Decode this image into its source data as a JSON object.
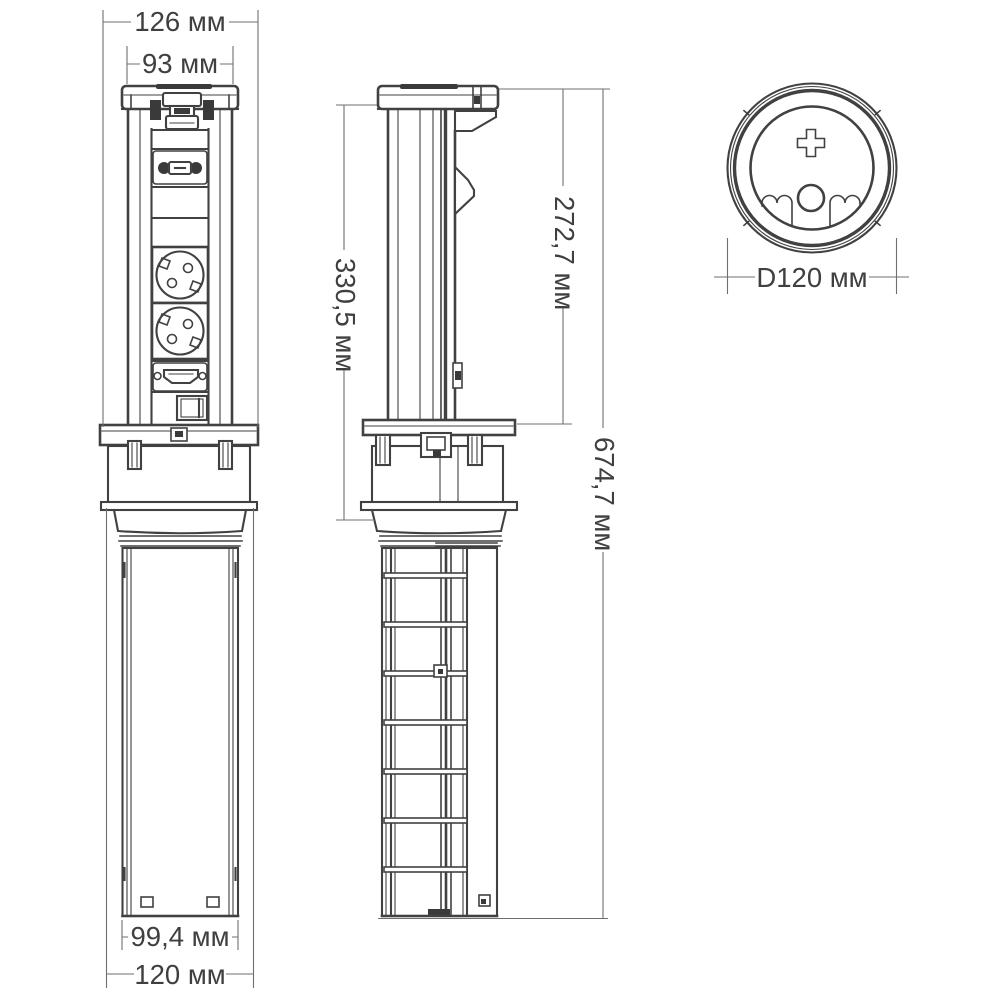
{
  "drawing": {
    "kind": "technical-dimension-drawing",
    "subject": "pop-up-socket-tower",
    "views": [
      "front-view",
      "side-view",
      "top-view"
    ],
    "features": [
      "lid-cap",
      "latch",
      "usb-ports",
      "schuko-socket-top",
      "schuko-socket-bottom",
      "hdmi-port",
      "switch-port",
      "mounting-flange",
      "threaded-collar",
      "locking-nut",
      "under-counter-tube",
      "plus-mark",
      "grip-reliefs"
    ]
  },
  "dims": {
    "front_outer_width": "126 мм",
    "front_cap_width": "93 мм",
    "tube_width": "99,4 мм",
    "base_width": "120 мм",
    "under_height": "330,5 мм",
    "above_height": "272,7 мм",
    "total_height": "674,7 мм",
    "diameter": "D120 мм"
  },
  "colors": {
    "background": "#ffffff",
    "stroke": "#414141",
    "dim_line": "#6f6f6f",
    "text": "#3f3f3f",
    "fill_dark": "#3a3a3a"
  }
}
